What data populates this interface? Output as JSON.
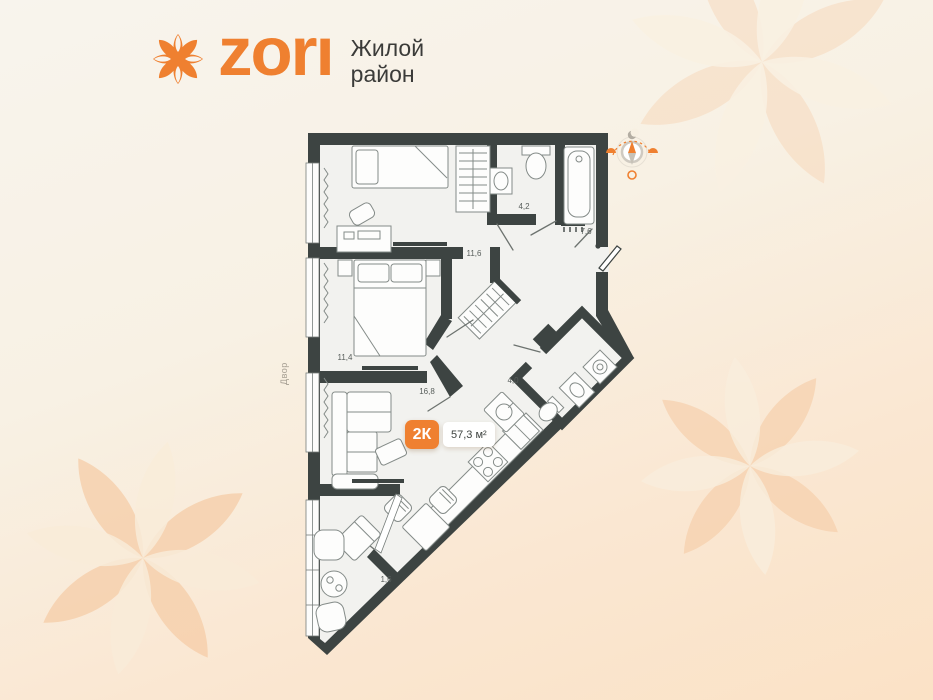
{
  "logo": {
    "brand": "zorı",
    "tagline1": "Жилой",
    "tagline2": "район"
  },
  "badge": {
    "type": "2К",
    "area": "57,3 м²"
  },
  "labels": {
    "hall": "11,6",
    "bedroom2": "11,4",
    "living": "16,8",
    "bath_small": "4,2",
    "bath_large": "7,6",
    "bath_entry": "4,0",
    "balcony": "1,6",
    "outside": "Двор"
  },
  "icons": {
    "logo_flower": "flower-icon",
    "compass": "sun-path-compass-icon"
  },
  "colors": {
    "accent": "#ef8030",
    "wall": "#3d4442",
    "floor": "#f2f2ef",
    "bg_top": "#f8f4ed",
    "bg_bottom": "#fbe2c6",
    "flower_peach": "#f6cca6",
    "flower_cream": "#f9efdf"
  }
}
